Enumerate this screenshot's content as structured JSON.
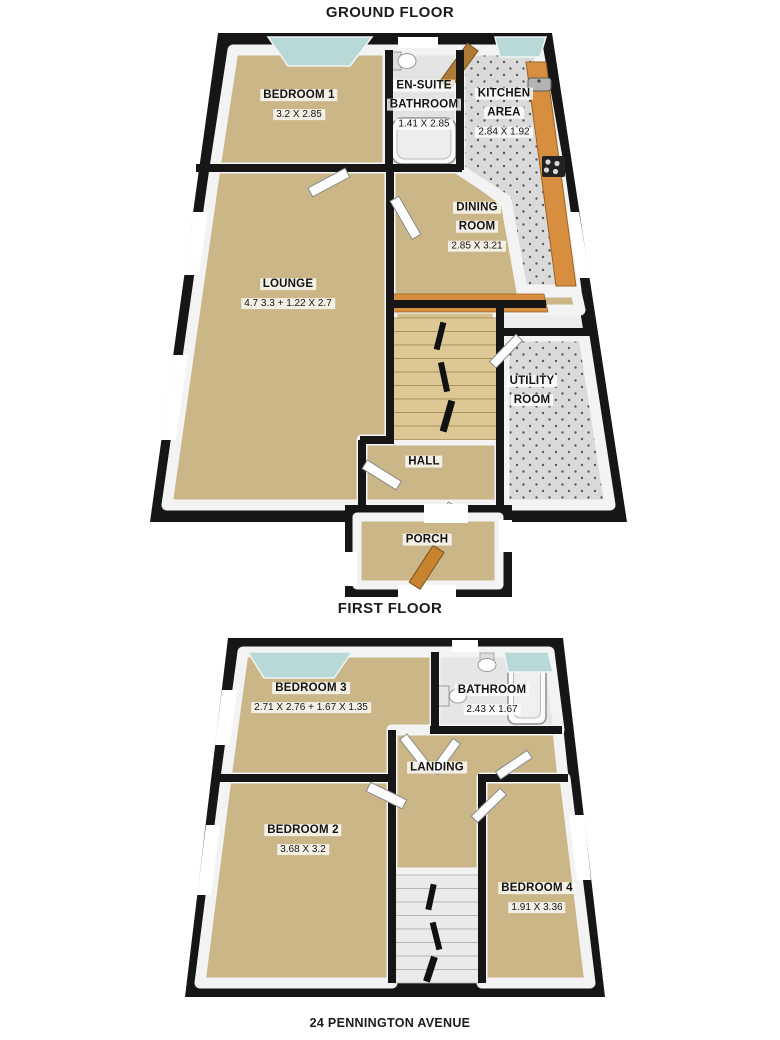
{
  "floors": [
    {
      "title": "GROUND FLOOR",
      "rooms": [
        {
          "name": "BEDROOM 1",
          "dims": "3.2 X 2.85"
        },
        {
          "name": "EN-SUITE BATHROOM",
          "dims": "1.41 X 2.85"
        },
        {
          "name": "KITCHEN AREA",
          "dims": "2.84 X 1.92"
        },
        {
          "name": "DINING ROOM",
          "dims": "2.85 X 3.21"
        },
        {
          "name": "LOUNGE",
          "dims": "4.7 3.3 + 1.22 X 2.7"
        },
        {
          "name": "UTILITY ROOM",
          "dims": ""
        },
        {
          "name": "HALL",
          "dims": ""
        },
        {
          "name": "PORCH",
          "dims": ""
        }
      ]
    },
    {
      "title": "FIRST FLOOR",
      "rooms": [
        {
          "name": "BEDROOM 3",
          "dims": "2.71 X 2.76 + 1.67 X 1.35"
        },
        {
          "name": "BATHROOM",
          "dims": "2.43 X 1.67"
        },
        {
          "name": "LANDING",
          "dims": ""
        },
        {
          "name": "BEDROOM 2",
          "dims": "3.68 X 3.2"
        },
        {
          "name": "BEDROOM 4",
          "dims": "1.91 X 3.36"
        }
      ]
    }
  ],
  "footer": {
    "address": "24 PENNINGTON AVENUE"
  },
  "colors": {
    "wall": "#161616",
    "floor_tan": "#cbb687",
    "tile_gray": "#dadada",
    "window_glass": "#b9d8d8",
    "counter_wood": "#d78e3f",
    "door_wood": "#b07a36",
    "fixture_white": "#fafafa"
  }
}
